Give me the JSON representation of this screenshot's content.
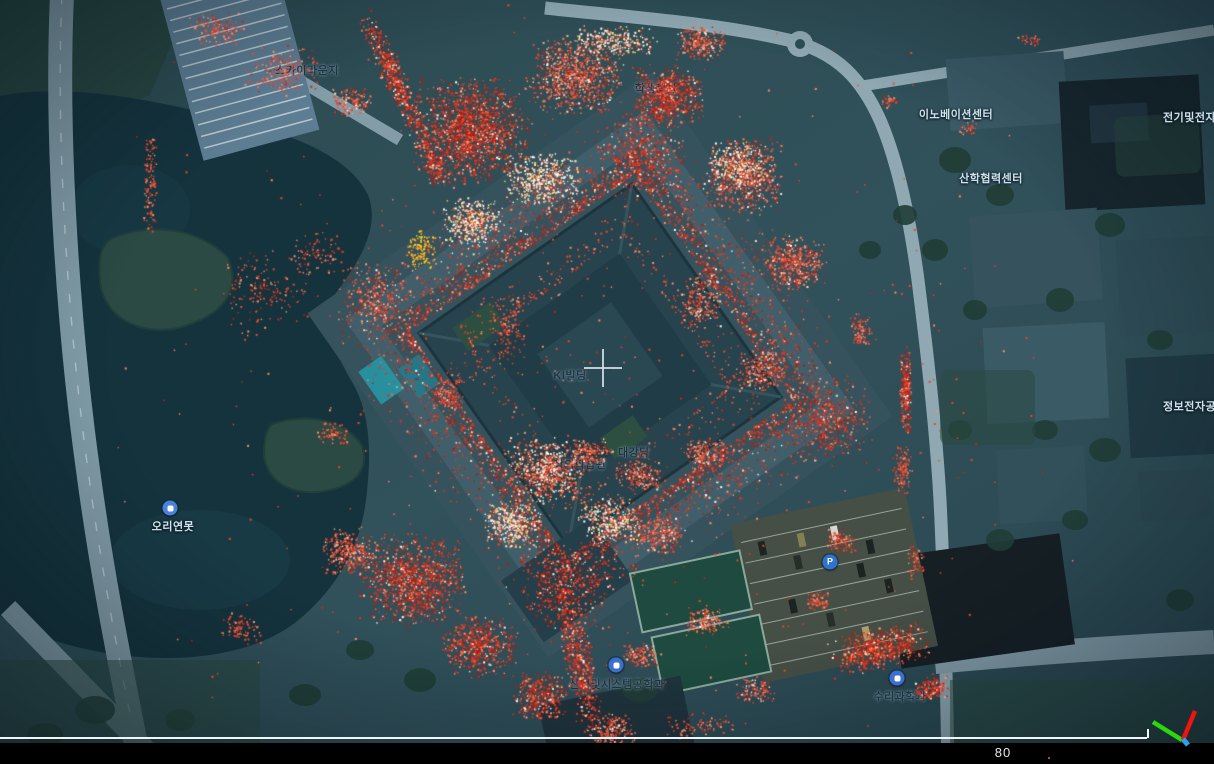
{
  "viewer": {
    "scale_label": "80",
    "scale_label_pos": {
      "x": 1003,
      "y": 745
    },
    "scale_line": {
      "x_start": 0,
      "x_end": 1147,
      "y": 737
    },
    "bottom_bar": {
      "top": 743,
      "height": 21
    },
    "bar_dot": {
      "x": 1048,
      "y": 757
    },
    "crosshair": {
      "x": 603,
      "y": 368
    },
    "axis_gizmo": {
      "axes": [
        {
          "name": "y-axis-green",
          "color": "#2bd80e",
          "x1": 1182,
          "y1": 740,
          "x2": 1153,
          "y2": 722,
          "w": 4.5
        },
        {
          "name": "x-axis-red",
          "color": "#ee1410",
          "x1": 1183,
          "y1": 740,
          "x2": 1195,
          "y2": 711,
          "w": 4.5
        },
        {
          "name": "z-axis-blue",
          "color": "#2f9ff2",
          "x1": 1183,
          "y1": 739,
          "x2": 1188,
          "y2": 745,
          "w": 5
        }
      ]
    }
  },
  "labels": [
    {
      "id": "sky-lounge",
      "text": "스카이라운지",
      "x": 307,
      "y": 70,
      "theme": "dark"
    },
    {
      "id": "student-hall",
      "text": "학생회관",
      "x": 656,
      "y": 88,
      "theme": "dark"
    },
    {
      "id": "innovation-center",
      "text": "이노베이션센터",
      "x": 956,
      "y": 114,
      "theme": "light"
    },
    {
      "id": "industry-academia-center",
      "text": "산학협력센터",
      "x": 991,
      "y": 178,
      "theme": "light"
    },
    {
      "id": "electrical-engineering",
      "text": "전기및전자공학부",
      "x": 1163,
      "y": 117,
      "theme": "light",
      "anchor": "left"
    },
    {
      "id": "info-electronics",
      "text": "정보전자공학동",
      "x": 1163,
      "y": 406,
      "theme": "light",
      "anchor": "left"
    },
    {
      "id": "ki-building",
      "text": "KI빌딩",
      "x": 570,
      "y": 375,
      "theme": "dark"
    },
    {
      "id": "duck-pond",
      "text": "오리연못",
      "x": 173,
      "y": 526,
      "theme": "light"
    },
    {
      "id": "creative-learning",
      "text": "창의학습관",
      "x": 580,
      "y": 464,
      "theme": "dark"
    },
    {
      "id": "auditorium",
      "text": "대강당",
      "x": 634,
      "y": 452,
      "theme": "dark"
    },
    {
      "id": "industrial-systems-eng",
      "text": "산업및시스템공학과",
      "x": 617,
      "y": 684,
      "theme": "dark"
    },
    {
      "id": "math-science",
      "text": "수리과학과",
      "x": 900,
      "y": 696,
      "theme": "dark"
    }
  ],
  "pois": [
    {
      "id": "duck-pond-poi",
      "x": 170,
      "y": 508,
      "color": "#4a82d9",
      "glyph": ""
    },
    {
      "id": "industrial-systems-poi",
      "x": 616,
      "y": 665,
      "color": "#3d6fd0",
      "glyph": ""
    },
    {
      "id": "math-science-poi",
      "x": 897,
      "y": 678,
      "color": "#3d6fd0",
      "glyph": ""
    },
    {
      "id": "parking-poi",
      "x": 830,
      "y": 562,
      "color": "#2e74cc",
      "glyph": "P"
    }
  ],
  "colors": {
    "land": "#2e4d55",
    "land_light": "#3a5a64",
    "water": "#15333d",
    "road": "#829ca8",
    "road_light": "#8fa8b2",
    "building": "#3a5a66",
    "building_dark": "#17262d",
    "ki_building": "#27434d",
    "tree": "#203d36",
    "grass": "#2b4a41",
    "parking_lot": "#454f46",
    "court_green": "#1e4a3e",
    "cloud_red": "#e8311d",
    "cloud_orange": "#ff6a3a",
    "cloud_cream": "#ffe7cc",
    "cloud_yellow": "#ffd020"
  },
  "point_cloud": {
    "seed": 42,
    "palettes": {
      "red_heavy": [
        [
          "#e8311d",
          0.52
        ],
        [
          "#c01708",
          0.2
        ],
        [
          "#ff6a3a",
          0.12
        ],
        [
          "#ff9478",
          0.09
        ],
        [
          "#ffd9b8",
          0.04
        ],
        [
          "#ffffff",
          0.03
        ]
      ],
      "red_mix": [
        [
          "#ea4530",
          0.45
        ],
        [
          "#ff7a4a",
          0.2
        ],
        [
          "#ff9e85",
          0.15
        ],
        [
          "#c22210",
          0.1
        ],
        [
          "#ffe3c8",
          0.07
        ],
        [
          "#ffffff",
          0.03
        ]
      ],
      "cream_mix": [
        [
          "#ffe7cc",
          0.3
        ],
        [
          "#ffffff",
          0.22
        ],
        [
          "#ffb089",
          0.18
        ],
        [
          "#ea4530",
          0.2
        ],
        [
          "#ffd24f",
          0.1
        ]
      ],
      "dense_mix": [
        [
          "#ea3a24",
          0.35
        ],
        [
          "#ffe7cc",
          0.25
        ],
        [
          "#ffffff",
          0.15
        ],
        [
          "#ff7a4a",
          0.25
        ]
      ],
      "sparse_red": [
        [
          "#e8482f",
          0.6
        ],
        [
          "#ff8a6a",
          0.25
        ],
        [
          "#c0281a",
          0.15
        ]
      ],
      "yellow_mix": [
        [
          "#ffd020",
          0.5
        ],
        [
          "#ffb31e",
          0.3
        ],
        [
          "#ff8438",
          0.2
        ]
      ]
    },
    "ring": {
      "cx": 600,
      "cy": 365,
      "rot": -35,
      "r_inner": 138,
      "r_outer": 208,
      "n": 3800,
      "palette": "red_heavy"
    },
    "inner_ring": {
      "cx": 600,
      "cy": 365,
      "rot": -35,
      "r_inner": 92,
      "r_outer": 138,
      "n": 450,
      "palette": "sparse_red"
    },
    "corner_blobs": [
      {
        "x": 640,
        "y": 155,
        "r": 46,
        "n": 380,
        "palette": "red_heavy"
      },
      {
        "x": 828,
        "y": 422,
        "r": 44,
        "n": 360,
        "palette": "red_heavy"
      },
      {
        "x": 566,
        "y": 586,
        "r": 46,
        "n": 380,
        "palette": "red_heavy"
      },
      {
        "x": 376,
        "y": 297,
        "r": 40,
        "n": 300,
        "palette": "red_mix"
      }
    ],
    "clusters": [
      {
        "x": 470,
        "y": 130,
        "rx": 62,
        "ry": 55,
        "rot": 0,
        "n": 1500,
        "p": "red_heavy"
      },
      {
        "x": 575,
        "y": 75,
        "rx": 50,
        "ry": 40,
        "rot": 0,
        "n": 900,
        "p": "red_mix"
      },
      {
        "x": 668,
        "y": 95,
        "rx": 38,
        "ry": 32,
        "rot": 0,
        "n": 600,
        "p": "red_heavy"
      },
      {
        "x": 745,
        "y": 175,
        "rx": 40,
        "ry": 40,
        "rot": 0,
        "n": 650,
        "p": "red_mix"
      },
      {
        "x": 792,
        "y": 262,
        "rx": 34,
        "ry": 30,
        "rot": 0,
        "n": 450,
        "p": "red_mix"
      },
      {
        "x": 700,
        "y": 42,
        "rx": 26,
        "ry": 18,
        "rot": 0,
        "n": 220,
        "p": "red_mix"
      },
      {
        "x": 612,
        "y": 40,
        "rx": 48,
        "ry": 16,
        "rot": 0,
        "n": 260,
        "p": "cream_mix"
      },
      {
        "x": 540,
        "y": 180,
        "rx": 40,
        "ry": 30,
        "rot": 0,
        "n": 500,
        "p": "cream_mix"
      },
      {
        "x": 472,
        "y": 222,
        "rx": 34,
        "ry": 26,
        "rot": 0,
        "n": 420,
        "p": "cream_mix"
      },
      {
        "x": 420,
        "y": 250,
        "rx": 16,
        "ry": 22,
        "rot": 0,
        "n": 120,
        "p": "yellow_mix"
      },
      {
        "x": 395,
        "y": 80,
        "rx": 13,
        "ry": 78,
        "rot": -25,
        "n": 520,
        "p": "red_heavy"
      },
      {
        "x": 433,
        "y": 165,
        "rx": 12,
        "ry": 30,
        "rot": -25,
        "n": 160,
        "p": "red_heavy"
      },
      {
        "x": 578,
        "y": 660,
        "rx": 16,
        "ry": 75,
        "rot": -12,
        "n": 520,
        "p": "red_heavy"
      },
      {
        "x": 545,
        "y": 470,
        "rx": 42,
        "ry": 34,
        "rot": 0,
        "n": 700,
        "p": "dense_mix"
      },
      {
        "x": 512,
        "y": 525,
        "rx": 30,
        "ry": 26,
        "rot": 0,
        "n": 380,
        "p": "cream_mix"
      },
      {
        "x": 610,
        "y": 520,
        "rx": 34,
        "ry": 24,
        "rot": 0,
        "n": 360,
        "p": "cream_mix"
      },
      {
        "x": 660,
        "y": 535,
        "rx": 26,
        "ry": 20,
        "rot": 0,
        "n": 240,
        "p": "red_mix"
      },
      {
        "x": 412,
        "y": 580,
        "rx": 55,
        "ry": 48,
        "rot": 0,
        "n": 1100,
        "p": "red_heavy"
      },
      {
        "x": 350,
        "y": 552,
        "rx": 30,
        "ry": 26,
        "rot": 0,
        "n": 320,
        "p": "red_mix"
      },
      {
        "x": 478,
        "y": 645,
        "rx": 40,
        "ry": 32,
        "rot": 0,
        "n": 520,
        "p": "red_heavy"
      },
      {
        "x": 540,
        "y": 695,
        "rx": 30,
        "ry": 26,
        "rot": 0,
        "n": 350,
        "p": "red_heavy"
      },
      {
        "x": 610,
        "y": 730,
        "rx": 26,
        "ry": 20,
        "rot": 0,
        "n": 200,
        "p": "red_mix"
      },
      {
        "x": 905,
        "y": 390,
        "rx": 6,
        "ry": 48,
        "rot": 0,
        "n": 260,
        "p": "red_heavy"
      },
      {
        "x": 902,
        "y": 470,
        "rx": 10,
        "ry": 26,
        "rot": 0,
        "n": 120,
        "p": "sparse_red"
      },
      {
        "x": 878,
        "y": 648,
        "rx": 52,
        "ry": 22,
        "rot": -12,
        "n": 600,
        "p": "red_heavy"
      },
      {
        "x": 930,
        "y": 688,
        "rx": 20,
        "ry": 12,
        "rot": -12,
        "n": 140,
        "p": "red_heavy"
      },
      {
        "x": 818,
        "y": 600,
        "rx": 14,
        "ry": 10,
        "rot": 0,
        "n": 70,
        "p": "sparse_red"
      },
      {
        "x": 150,
        "y": 185,
        "rx": 7,
        "ry": 55,
        "rot": 0,
        "n": 120,
        "p": "sparse_red"
      },
      {
        "x": 262,
        "y": 292,
        "rx": 48,
        "ry": 46,
        "rot": 0,
        "n": 160,
        "p": "sparse_red"
      },
      {
        "x": 318,
        "y": 252,
        "rx": 30,
        "ry": 22,
        "rot": 0,
        "n": 80,
        "p": "sparse_red"
      },
      {
        "x": 240,
        "y": 628,
        "rx": 24,
        "ry": 16,
        "rot": 0,
        "n": 90,
        "p": "sparse_red"
      },
      {
        "x": 332,
        "y": 433,
        "rx": 16,
        "ry": 12,
        "rot": 0,
        "n": 60,
        "p": "sparse_red"
      },
      {
        "x": 282,
        "y": 70,
        "rx": 40,
        "ry": 26,
        "rot": 0,
        "n": 170,
        "p": "sparse_red"
      },
      {
        "x": 218,
        "y": 28,
        "rx": 30,
        "ry": 18,
        "rot": 0,
        "n": 120,
        "p": "sparse_red"
      },
      {
        "x": 350,
        "y": 100,
        "rx": 22,
        "ry": 16,
        "rot": 0,
        "n": 130,
        "p": "red_mix"
      },
      {
        "x": 735,
        "y": 165,
        "rx": 34,
        "ry": 26,
        "rot": 0,
        "n": 300,
        "p": "cream_mix"
      },
      {
        "x": 700,
        "y": 300,
        "rx": 22,
        "ry": 30,
        "rot": 0,
        "n": 220,
        "p": "red_mix"
      },
      {
        "x": 760,
        "y": 370,
        "rx": 26,
        "ry": 22,
        "rot": 0,
        "n": 240,
        "p": "red_mix"
      },
      {
        "x": 705,
        "y": 455,
        "rx": 24,
        "ry": 18,
        "rot": 0,
        "n": 200,
        "p": "red_mix"
      },
      {
        "x": 640,
        "y": 475,
        "rx": 26,
        "ry": 16,
        "rot": 0,
        "n": 180,
        "p": "red_mix"
      },
      {
        "x": 588,
        "y": 452,
        "rx": 26,
        "ry": 14,
        "rot": 0,
        "n": 170,
        "p": "red_mix"
      },
      {
        "x": 860,
        "y": 330,
        "rx": 12,
        "ry": 20,
        "rot": 0,
        "n": 90,
        "p": "sparse_red"
      },
      {
        "x": 840,
        "y": 540,
        "rx": 16,
        "ry": 12,
        "rot": 0,
        "n": 80,
        "p": "sparse_red"
      },
      {
        "x": 968,
        "y": 128,
        "rx": 10,
        "ry": 8,
        "rot": 0,
        "n": 30,
        "p": "sparse_red"
      },
      {
        "x": 1030,
        "y": 40,
        "rx": 14,
        "ry": 6,
        "rot": 0,
        "n": 30,
        "p": "sparse_red"
      },
      {
        "x": 890,
        "y": 100,
        "rx": 10,
        "ry": 8,
        "rot": 0,
        "n": 35,
        "p": "sparse_red"
      },
      {
        "x": 705,
        "y": 620,
        "rx": 24,
        "ry": 16,
        "rot": 0,
        "n": 150,
        "p": "red_mix"
      },
      {
        "x": 755,
        "y": 690,
        "rx": 20,
        "ry": 14,
        "rot": 0,
        "n": 110,
        "p": "red_mix"
      },
      {
        "x": 640,
        "y": 655,
        "rx": 20,
        "ry": 14,
        "rot": 0,
        "n": 120,
        "p": "red_mix"
      },
      {
        "x": 700,
        "y": 725,
        "rx": 40,
        "ry": 14,
        "rot": 0,
        "n": 90,
        "p": "sparse_red"
      },
      {
        "x": 508,
        "y": 330,
        "rx": 20,
        "ry": 40,
        "rot": 0,
        "n": 150,
        "p": "sparse_red"
      },
      {
        "x": 450,
        "y": 390,
        "rx": 16,
        "ry": 26,
        "rot": 0,
        "n": 110,
        "p": "sparse_red"
      },
      {
        "x": 915,
        "y": 560,
        "rx": 10,
        "ry": 20,
        "rot": 0,
        "n": 60,
        "p": "sparse_red"
      }
    ],
    "scatter": {
      "cx": 590,
      "cy": 370,
      "rx": 500,
      "ry": 390,
      "n": 550,
      "p": "sparse_red"
    }
  }
}
